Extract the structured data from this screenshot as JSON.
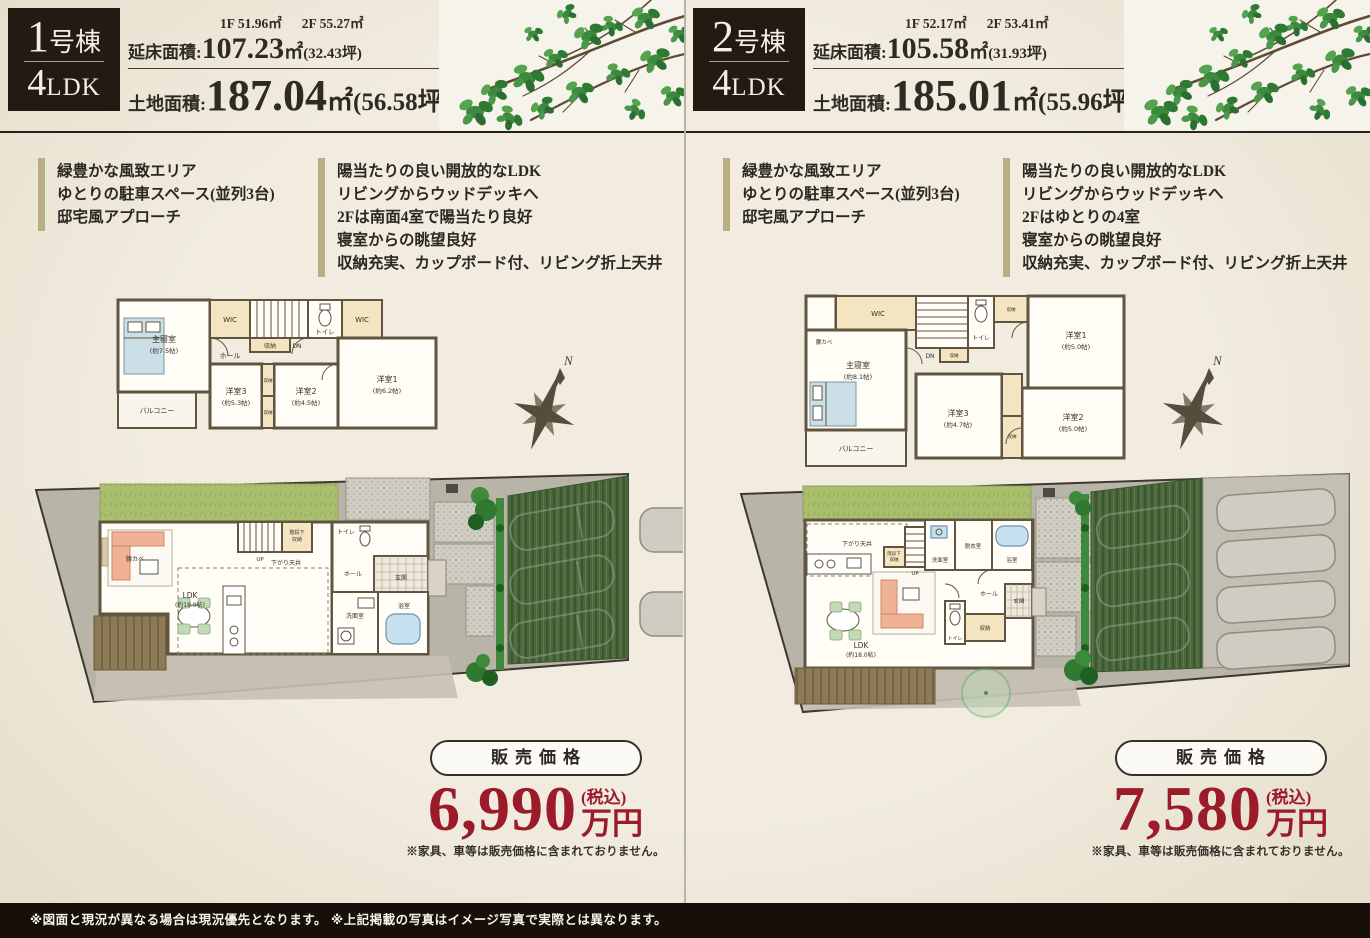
{
  "page": {
    "accent_red": "#9c1b2b",
    "background": "#ece5d6",
    "footer_note": "※図面と現況が異なる場合は現況優先となります。 ※上記掲載の写真はイメージ写真で実際とは異なります。"
  },
  "units": [
    {
      "badge": {
        "number": "1",
        "suffix": "号棟",
        "plan_number": "4",
        "plan_letters": "LDK"
      },
      "areas": {
        "floor1": "1F 51.96㎡",
        "floor2": "2F 55.27㎡",
        "total_label": "延床面積:",
        "total_value": "107.23",
        "total_unit": "㎡",
        "total_tsubo": "(32.43坪)",
        "land_label": "土地面積:",
        "land_value": "187.04",
        "land_unit": "㎡",
        "land_tsubo": "(56.58坪)"
      },
      "features_env": [
        "緑豊かな風致エリア",
        "ゆとりの駐車スペース(並列3台)",
        "邸宅風アプローチ"
      ],
      "features_plan": [
        "陽当たりの良い開放的なLDK",
        "リビングからウッドデッキへ",
        "2Fは南面4室で陽当たり良好",
        "寝室からの眺望良好",
        "収納充実、カップボード付、リビング折上天井"
      ],
      "compass_n": "N",
      "plan2f": {
        "shushinshitsu": "主寝室",
        "shushinshitsu_size": "(約7.5帖)",
        "wic1": "WIC",
        "wic2": "WIC",
        "shunou_top": "収納",
        "hall": "ホール",
        "toilet": "トイレ",
        "dn": "DN",
        "yoshitsu1": "洋室1",
        "yoshitsu1_size": "(約6.2帖)",
        "yoshitsu2": "洋室2",
        "yoshitsu2_size": "(約4.5帖)",
        "yoshitsu3": "洋室3",
        "yoshitsu3_size": "(約5.3帖)",
        "shunou_a": "収納",
        "shunou_b": "収納",
        "balcony": "バルコニー"
      },
      "plan1f": {
        "ldk": "LDK",
        "ldk_size": "(約18.9帖)",
        "koshikabe": "腰カベ",
        "sagaritenjo": "下がり天井",
        "up": "UP",
        "kaidanshita": "階段下",
        "kaidanshita2": "収納",
        "hall": "ホール",
        "genkan": "玄関",
        "toilet": "トイレ",
        "senmen": "洗面室",
        "bath": "浴室"
      },
      "price": {
        "label": "販売価格",
        "value": "6,990",
        "unit": "万円",
        "tax": "(税込)",
        "note": "※家具、車等は販売価格に含まれておりません。"
      }
    },
    {
      "badge": {
        "number": "2",
        "suffix": "号棟",
        "plan_number": "4",
        "plan_letters": "LDK"
      },
      "areas": {
        "floor1": "1F 52.17㎡",
        "floor2": "2F 53.41㎡",
        "total_label": "延床面積:",
        "total_value": "105.58",
        "total_unit": "㎡",
        "total_tsubo": "(31.93坪)",
        "land_label": "土地面積:",
        "land_value": "185.01",
        "land_unit": "㎡",
        "land_tsubo": "(55.96坪)"
      },
      "features_env": [
        "緑豊かな風致エリア",
        "ゆとりの駐車スペース(並列3台)",
        "邸宅風アプローチ"
      ],
      "features_plan": [
        "陽当たりの良い開放的なLDK",
        "リビングからウッドデッキへ",
        "2Fはゆとりの4室",
        "寝室からの眺望良好",
        "収納充実、カップボード付、リビング折上天井"
      ],
      "compass_n": "N",
      "plan2f": {
        "wic": "WIC",
        "koshikabe": "腰カベ",
        "shushinshitsu": "主寝室",
        "shushinshitsu_size": "(約8.1帖)",
        "dn": "DN",
        "toilet": "トイレ",
        "shunou_top": "収納",
        "yoshitsu1": "洋室1",
        "yoshitsu1_size": "(約5.0帖)",
        "yoshitsu2": "洋室2",
        "yoshitsu2_size": "(約5.0帖)",
        "yoshitsu3": "洋室3",
        "yoshitsu3_size": "(約4.7帖)",
        "shunou_a": "収納",
        "shunou_b": "収納",
        "balcony": "バルコニー"
      },
      "plan1f": {
        "sagaritenjo": "下がり天井",
        "kaidanshita": "階段下",
        "kaidanshita2": "収納",
        "up": "UP",
        "senmen": "洗面室",
        "datsui": "脱衣室",
        "bath": "浴室",
        "ldk": "LDK",
        "ldk_size": "(約18.0帖)",
        "hall": "ホール",
        "genkan": "玄関",
        "toilet": "トイレ",
        "shunou": "収納"
      },
      "price": {
        "label": "販売価格",
        "value": "7,580",
        "unit": "万円",
        "tax": "(税込)",
        "note": "※家具、車等は販売価格に含まれておりません。"
      }
    }
  ]
}
